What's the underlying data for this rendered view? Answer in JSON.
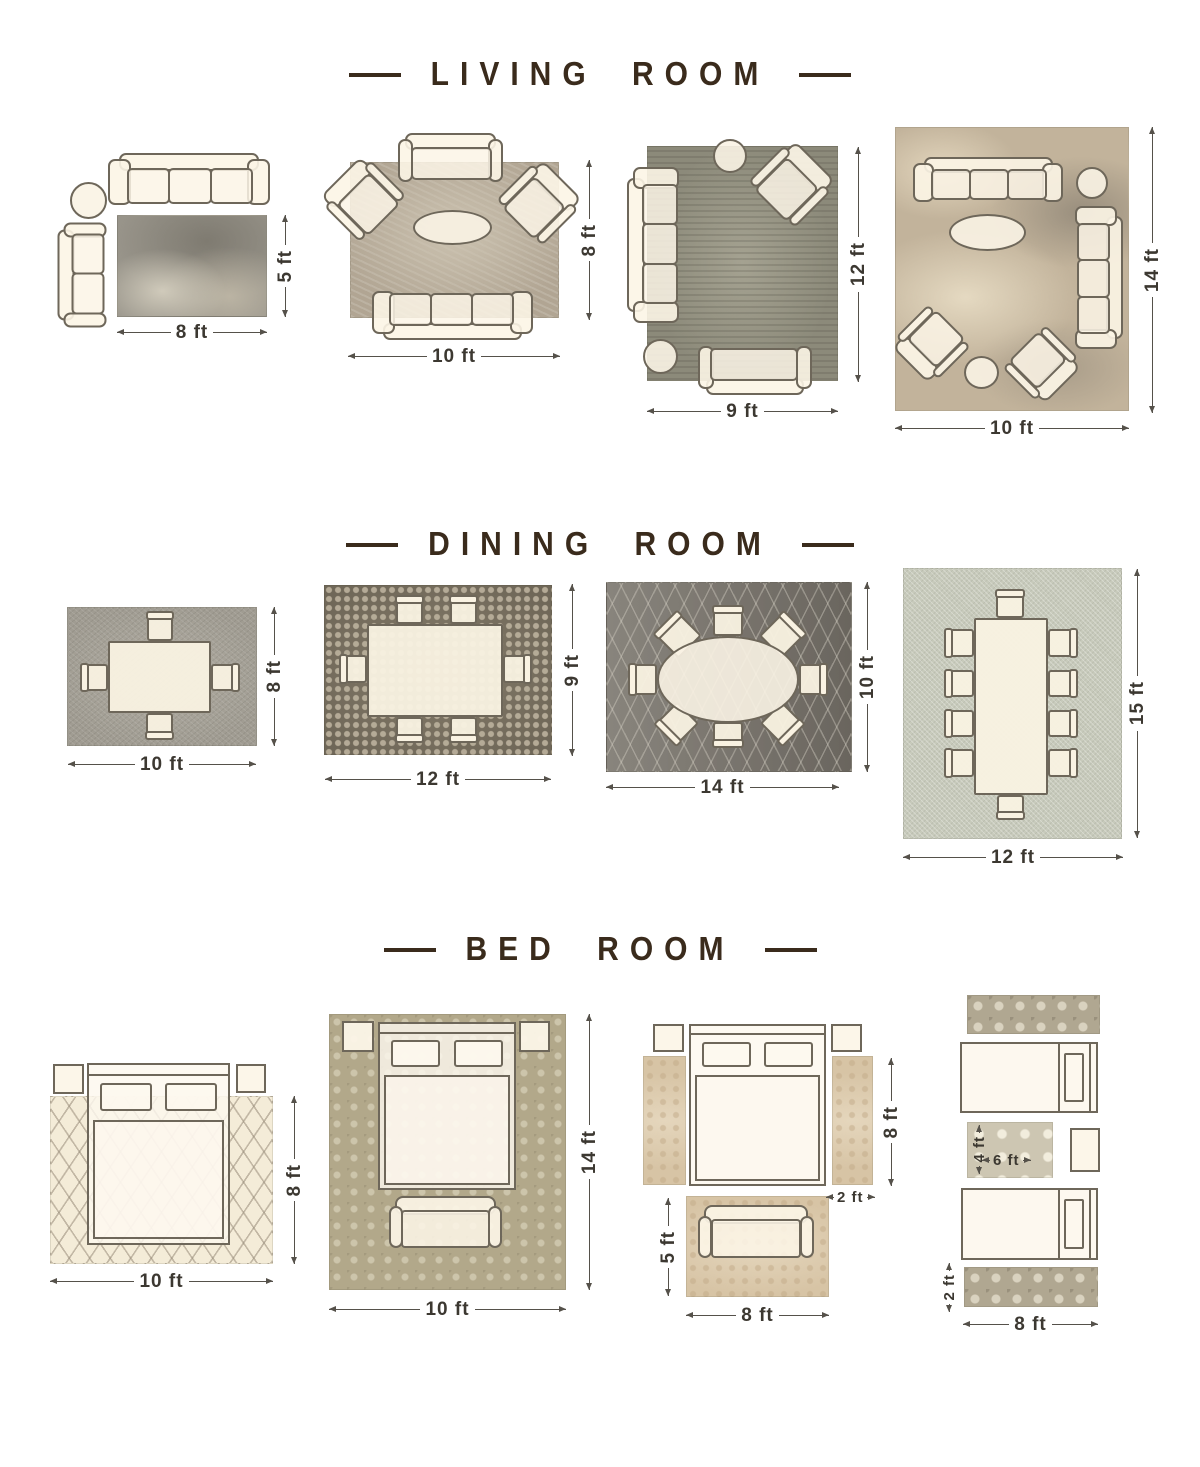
{
  "colors": {
    "title": "#3a2b1c",
    "dimension": "#3c3831",
    "furniture_fill": "#fbf4e5",
    "furniture_outline": "#6e675a"
  },
  "sections": [
    {
      "id": "living-room",
      "title": "LIVING ROOM",
      "layouts": [
        {
          "id": "living-rug-8x5",
          "width_label": "8 ft",
          "height_label": "5 ft"
        },
        {
          "id": "living-rug-10x8",
          "width_label": "10 ft",
          "height_label": "8 ft"
        },
        {
          "id": "living-rug-9x12",
          "width_label": "9 ft",
          "height_label": "12 ft"
        },
        {
          "id": "living-rug-10x14",
          "width_label": "10 ft",
          "height_label": "14 ft"
        }
      ]
    },
    {
      "id": "dining-room",
      "title": "DINING ROOM",
      "layouts": [
        {
          "id": "dining-rug-10x8",
          "width_label": "10 ft",
          "height_label": "8 ft"
        },
        {
          "id": "dining-rug-12x9",
          "width_label": "12 ft",
          "height_label": "9 ft"
        },
        {
          "id": "dining-rug-14x10",
          "width_label": "14 ft",
          "height_label": "10 ft"
        },
        {
          "id": "dining-rug-12x15",
          "width_label": "12 ft",
          "height_label": "15 ft"
        }
      ]
    },
    {
      "id": "bed-room",
      "title": "BED ROOM",
      "layouts": [
        {
          "id": "bed-rug-10x8",
          "width_label": "10 ft",
          "height_label": "8 ft"
        },
        {
          "id": "bed-rug-10x14",
          "width_label": "10 ft",
          "height_label": "14 ft"
        },
        {
          "id": "bed-runners-foot-rug",
          "runner_length_label": "8 ft",
          "runner_width_label": "2 ft",
          "foot_rug_height_label": "5 ft",
          "foot_rug_width_label": "8 ft"
        },
        {
          "id": "twin-beds-runners",
          "mid_rug_height_label": "4 ft",
          "mid_rug_width_label": "6 ft",
          "runner_width_label": "2 ft",
          "runner_length_label": "8 ft"
        }
      ]
    }
  ]
}
